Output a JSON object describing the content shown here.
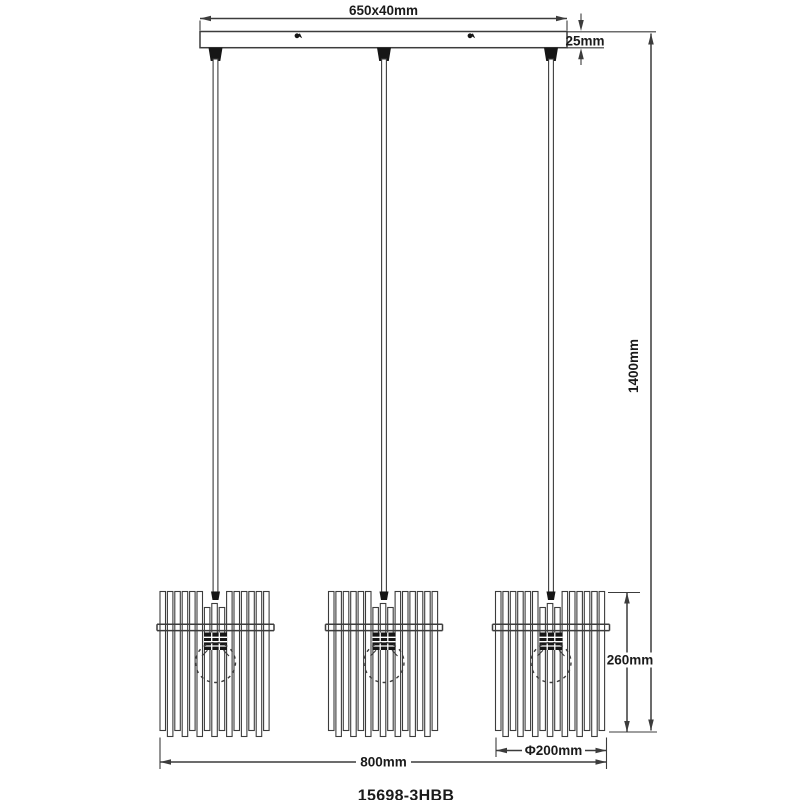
{
  "labels": {
    "canopy_size": "650x40mm",
    "canopy_height": "25mm",
    "suspension_height": "1400mm",
    "shade_height": "260mm",
    "shade_diameter": "Φ200mm",
    "overall_width": "800mm",
    "model_number": "15698-3HBB"
  },
  "colors": {
    "background": "#ffffff",
    "line": "#3c3c3c",
    "dark_fill": "#161616",
    "text": "#1b1b1b"
  }
}
